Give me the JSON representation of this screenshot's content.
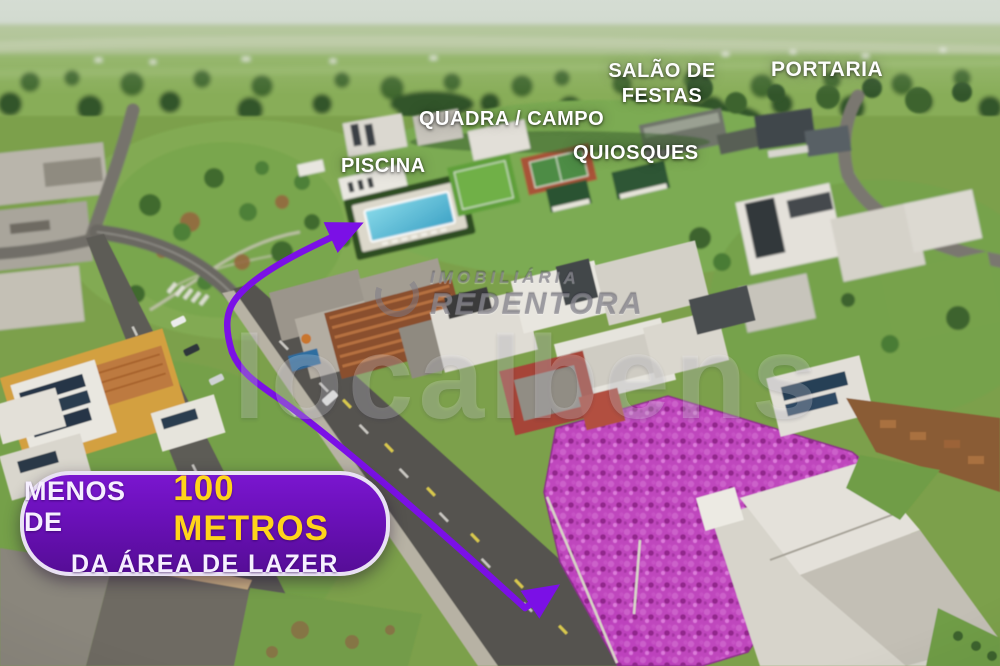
{
  "labels": {
    "piscina": "PISCINA",
    "quadra_campo": "QUADRA / CAMPO",
    "quiosques": "QUIOSQUES",
    "salao_de_festas": "SALÃO DE FESTAS",
    "portaria": "PORTARIA"
  },
  "badge": {
    "line1_prefix": "MENOS DE",
    "line1_highlight": "100 METROS",
    "line2": "DA ÁREA DE LAZER",
    "bg_color": "#6a10b8",
    "border_color": "#e9e1f4",
    "text_color": "#f6efff",
    "highlight_color": "#ffd41a"
  },
  "watermark": {
    "agency_line1": "IMOBILIÁRIA",
    "agency_line2": "REDENTORA",
    "portal": "localbens"
  },
  "annotation": {
    "arrow_color": "#7b10e6",
    "lot_highlight_color": "#c243c2"
  }
}
